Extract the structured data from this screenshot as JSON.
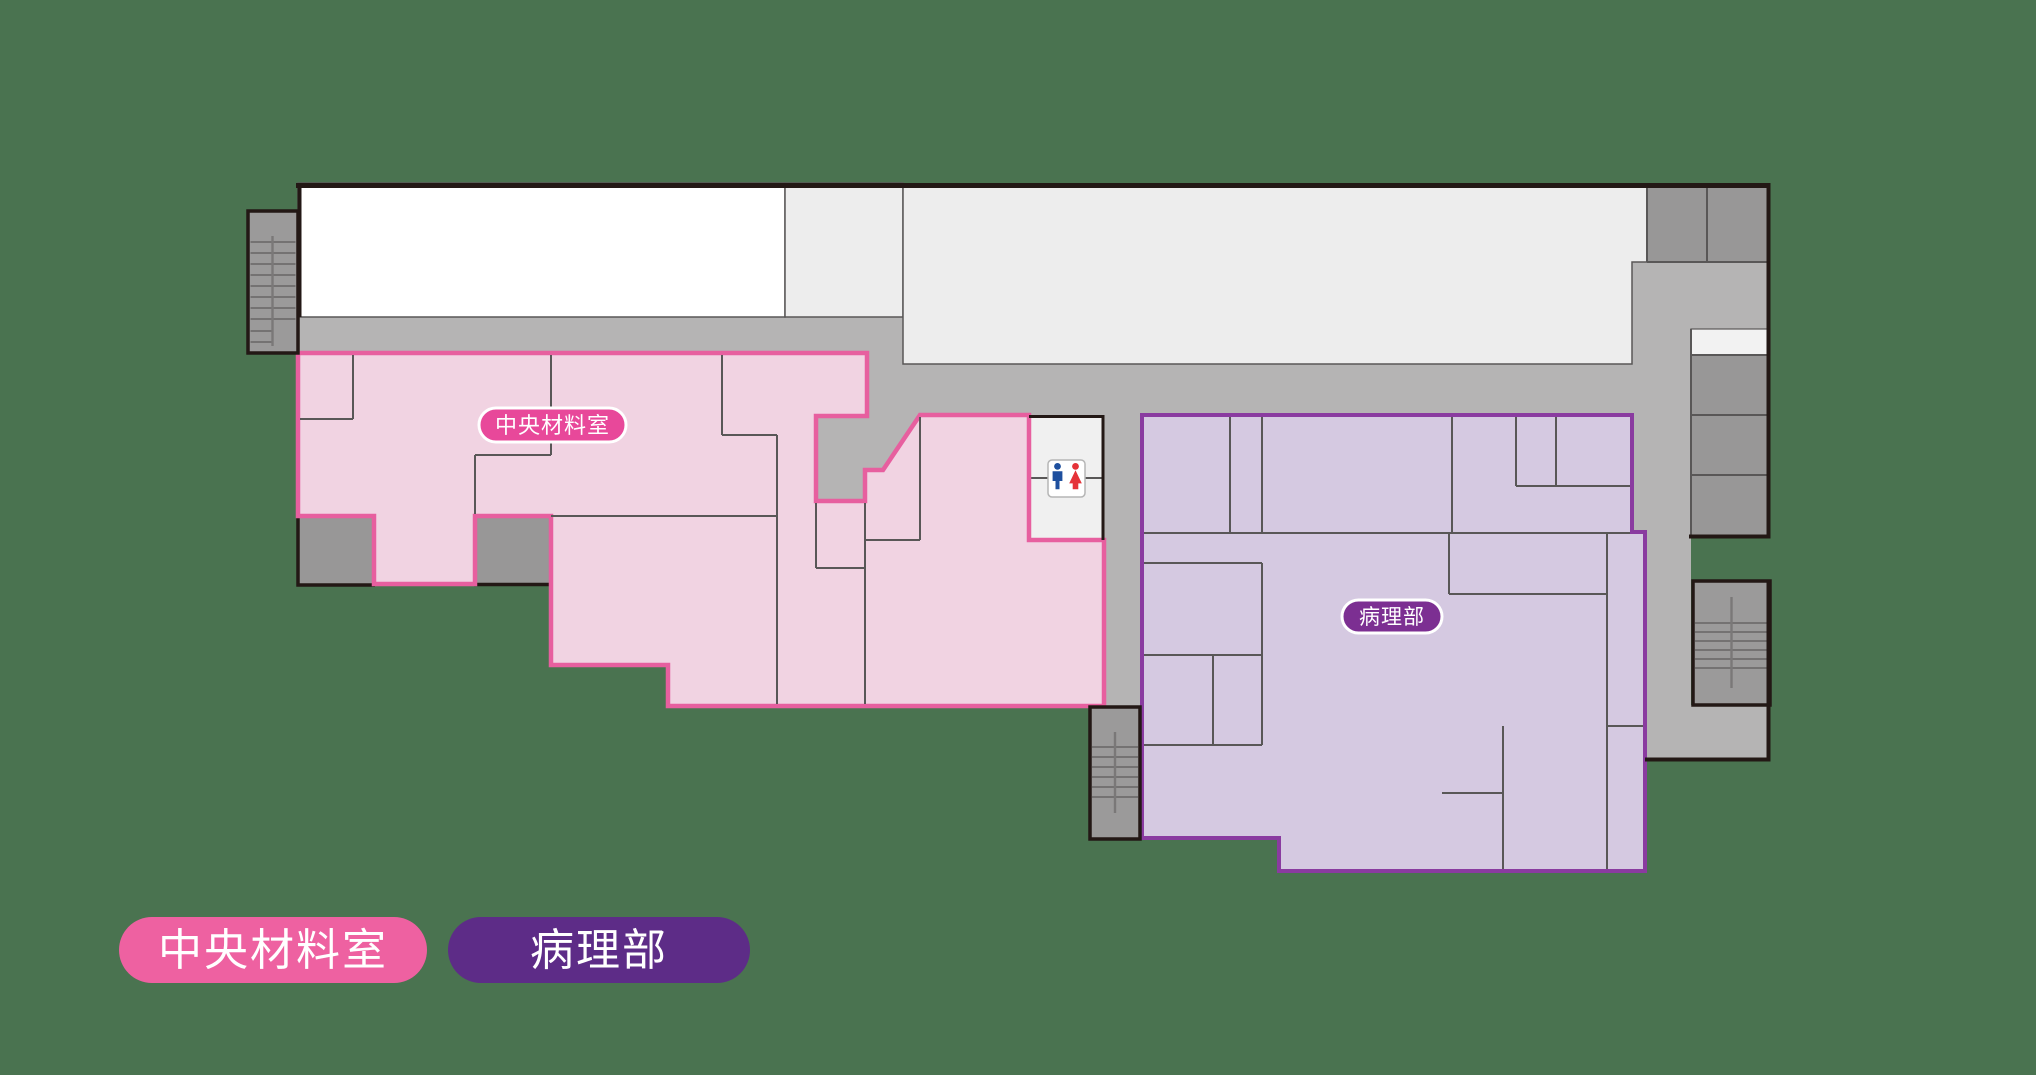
{
  "colors": {
    "bg": "#4a7350",
    "outline": "#231815",
    "wall": "#595757",
    "corridor": "#b5b4b4",
    "stair_gray": "#9b9a9a",
    "box_gray": "#989797",
    "room_white": "#ffffff",
    "room_light": "#ededed",
    "lobby_white": "#f2f2f2",
    "pink_fill": "#f1d3e2",
    "pink_line": "#e75f9f",
    "pink_pill": "#e8489a",
    "purple_fill": "#d5c9e1",
    "purple_line": "#8a3ba0",
    "purple_pill": "#7c2f92",
    "legend_pink": "#ee61a1",
    "legend_purple": "#5d2c87",
    "toilet_blue": "#1e4f9e",
    "toilet_red": "#e53238",
    "sign_border": "#b5b5b5",
    "label_text": "#ffffff"
  },
  "map": {
    "areas": [
      {
        "id": "central-materials",
        "label": "中央材料室"
      },
      {
        "id": "pathology",
        "label": "病理部"
      }
    ],
    "icons": [
      {
        "name": "restroom-icon",
        "glyph": "male-female-pictogram"
      },
      {
        "name": "stairs-icon",
        "glyph": "stair-treads"
      }
    ]
  },
  "legend": {
    "items": [
      {
        "id": "central-materials",
        "label": "中央材料室",
        "color": "#ee61a1"
      },
      {
        "id": "pathology",
        "label": "病理部",
        "color": "#5d2c87"
      }
    ]
  }
}
